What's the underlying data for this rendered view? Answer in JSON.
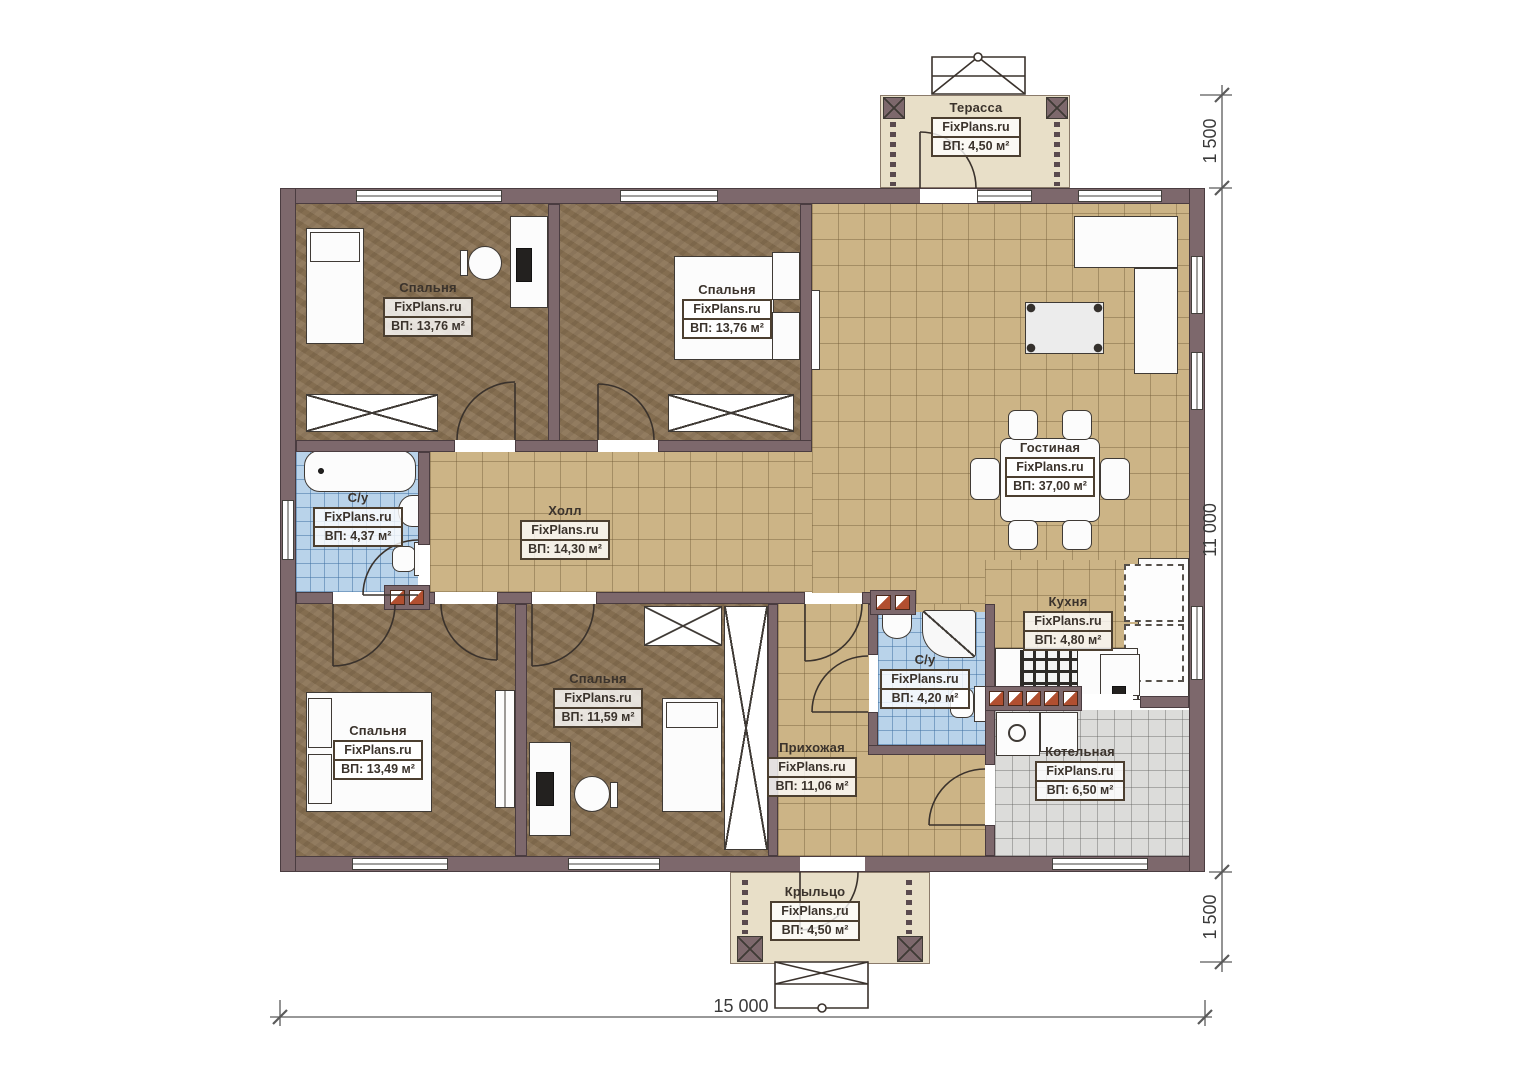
{
  "rooms": {
    "terrace": {
      "name": "Терасса",
      "brand": "FixPlans.ru",
      "area": "ВП: 4,50 м²"
    },
    "bedroom_top_left": {
      "name": "Спальня",
      "brand": "FixPlans.ru",
      "area": "ВП: 13,76 м²"
    },
    "bedroom_top_mid": {
      "name": "Спальня",
      "brand": "FixPlans.ru",
      "area": "ВП: 13,76 м²"
    },
    "living": {
      "name": "Гостиная",
      "brand": "FixPlans.ru",
      "area": "ВП: 37,00 м²"
    },
    "bath_left": {
      "name": "С/у",
      "brand": "FixPlans.ru",
      "area": "ВП: 4,37 м²"
    },
    "hall": {
      "name": "Холл",
      "brand": "FixPlans.ru",
      "area": "ВП: 14,30 м²"
    },
    "kitchen": {
      "name": "Кухня",
      "brand": "FixPlans.ru",
      "area": "ВП: 4,80 м²"
    },
    "bedroom_bottom_left": {
      "name": "Спальня",
      "brand": "FixPlans.ru",
      "area": "ВП: 13,49 м²"
    },
    "bedroom_bottom_mid": {
      "name": "Спальня",
      "brand": "FixPlans.ru",
      "area": "ВП: 11,59 м²"
    },
    "entry": {
      "name": "Прихожая",
      "brand": "FixPlans.ru",
      "area": "ВП: 11,06 м²"
    },
    "bath_mid": {
      "name": "С/у",
      "brand": "FixPlans.ru",
      "area": "ВП: 4,20 м²"
    },
    "boiler": {
      "name": "Котельная",
      "brand": "FixPlans.ru",
      "area": "ВП: 6,50 м²"
    },
    "porch": {
      "name": "Крыльцо",
      "brand": "FixPlans.ru",
      "area": "ВП: 4,50 м²"
    }
  },
  "dimensions": {
    "right_top": "1 500",
    "right_middle": "11 000",
    "right_bottom": "1 500",
    "bottom": "15 000"
  },
  "colors": {
    "wall": "#7d686c",
    "wall-line": "#4a3c40",
    "tile": "#ccb486",
    "carpet": "#8c7557",
    "bath-tile": "#b9d3ea",
    "gray-tile": "#dcdcda",
    "deck": "#e8dfc8",
    "ink": "#3b332c",
    "brick": "#b14f30"
  }
}
